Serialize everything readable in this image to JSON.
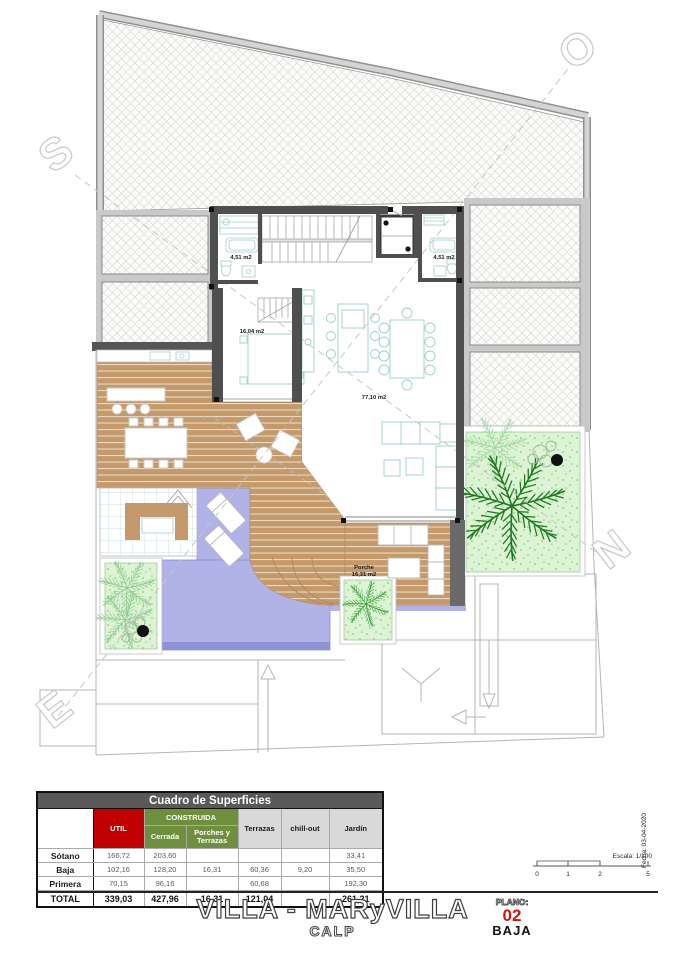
{
  "compass": {
    "s": "S",
    "o": "O",
    "e": "E",
    "n": "N"
  },
  "plan_labels": {
    "bath_left": "4,51 m2",
    "bath_right": "4,51 m2",
    "bedroom": "16,04 m2",
    "living": "77,10 m2",
    "porch_name": "Porche",
    "porch_area": "16,31 m2"
  },
  "scalebar": {
    "escala": "Escala: 1/100",
    "fecha": "Fecha: 03-04-2020",
    "ticks": [
      "0",
      "1",
      "2",
      "5"
    ]
  },
  "table": {
    "title": "Cuadro de Superficies",
    "col_util": "UTIL",
    "col_construida": "CONSTRUIDA",
    "col_cerrada": "Cerrada",
    "col_porches": "Porches y Terrazas",
    "col_terrazas": "Terrazas",
    "col_chillout": "chill-out",
    "col_jardin": "Jardín",
    "rows": [
      {
        "label": "Sótano",
        "util": "166,72",
        "cerrada": "203,60",
        "porches": "",
        "terrazas": "",
        "chillout": "",
        "jardin": "33,41"
      },
      {
        "label": "Baja",
        "util": "102,16",
        "cerrada": "128,20",
        "porches": "16,31",
        "terrazas": "60,36",
        "chillout": "9,20",
        "jardin": "35,50"
      },
      {
        "label": "Primera",
        "util": "70,15",
        "cerrada": "96,16",
        "porches": "",
        "terrazas": "60,68",
        "chillout": "",
        "jardin": "192,30"
      },
      {
        "label": "TOTAL",
        "util": "339,03",
        "cerrada": "427,96",
        "porches": "16,31",
        "terrazas": "121,04",
        "chillout": "",
        "jardin": "261,21"
      }
    ]
  },
  "titleblock": {
    "project": "VILLA - MARyVILLA",
    "location": "CALP",
    "plano_label": "PLANO:",
    "plano_num": "02",
    "plano_name": "BAJA"
  },
  "colors": {
    "wall": "#4f4f4f",
    "deck": "#c49a6c",
    "pool": "#b1b2e8",
    "garden": "#dcf3d4",
    "palm": "#1e7a1e",
    "table_red": "#c00000",
    "table_green": "#6f8f3f",
    "table_gray": "#d9d9d9",
    "table_header": "#595959",
    "plano_red": "#cc1512"
  }
}
